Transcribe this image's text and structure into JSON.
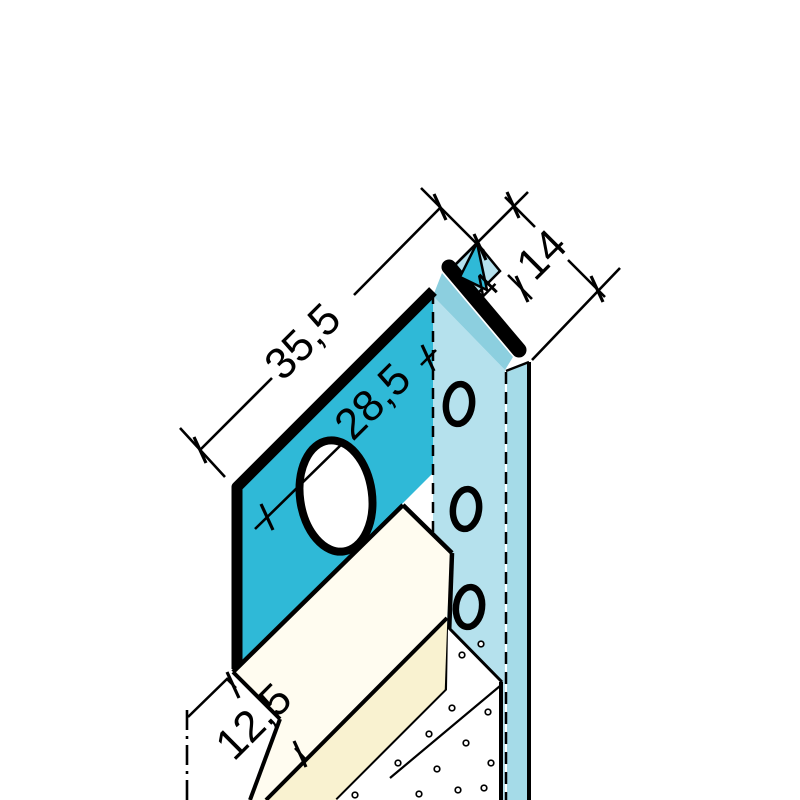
{
  "diagram": {
    "kind": "technical-drawing",
    "subject": "plaster-edge-profile-cross-section",
    "dimensions": {
      "total_width": "35,5",
      "face_width": "28,5",
      "channel_width": "14",
      "gap": "4",
      "board_thickness": "12,5"
    },
    "colors": {
      "background": "#ffffff",
      "outline": "#000000",
      "profile_dark": "#2fb9d7",
      "profile_light": "#b5e1ed",
      "profile_medium": "#8ccfdf",
      "profile_side": "#a5dbe8",
      "board_top": "#fffcf0",
      "board_front": "#f9f2d0",
      "hole_fill": "#ffffff"
    }
  }
}
